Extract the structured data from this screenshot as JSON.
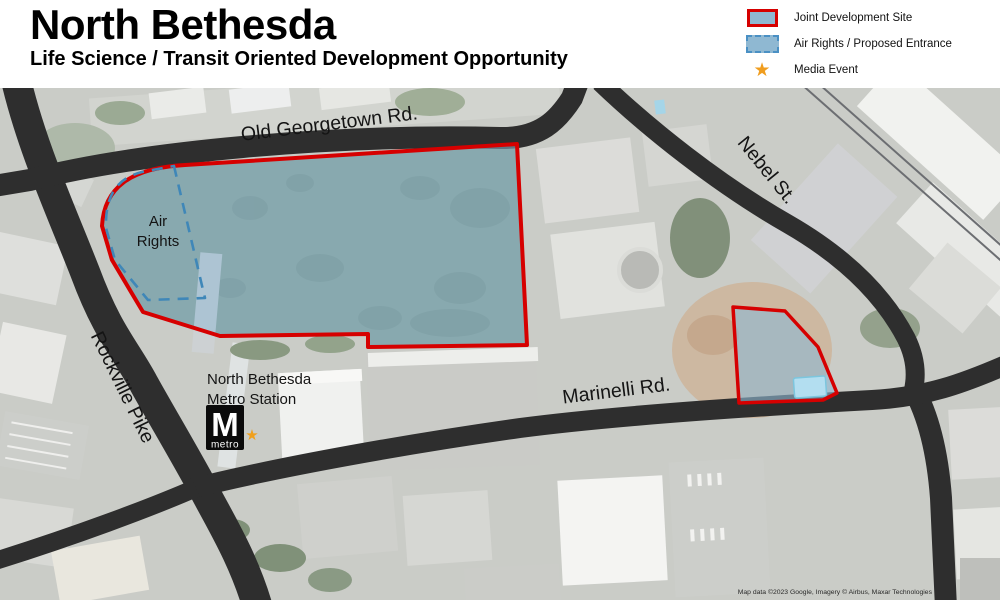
{
  "header": {
    "title": "North Bethesda",
    "subtitle": "Life Science / Transit Oriented Development Opportunity"
  },
  "legend": {
    "items": [
      {
        "swatch": "red-outline-blue-fill",
        "label": "Joint Development Site"
      },
      {
        "swatch": "blue-dashed-blue-fill",
        "label": "Air Rights / Proposed Entrance"
      },
      {
        "swatch": "orange-star",
        "label": "Media Event"
      }
    ]
  },
  "map": {
    "road_labels": {
      "old_georgetown": "Old Georgetown Rd.",
      "nebel": "Nebel St.",
      "rockville": "Rockville Pike",
      "marinelli": "Marinelli Rd."
    },
    "air_rights": {
      "line1": "Air",
      "line2": "Rights"
    },
    "station": {
      "name_line1": "North Bethesda",
      "name_line2": "Metro Station",
      "logo_letter": "M",
      "logo_word": "metro"
    },
    "attribution": "Map data ©2023 Google, Imagery © Airbus, Maxar Technologies"
  },
  "glyphs": {
    "star": "★"
  },
  "colors": {
    "site_outline": "#d60000",
    "site_fill": "#8fb8d2",
    "air_rights_outline": "#3f87b8",
    "media_event_star": "#f09d1e",
    "road": "#2e2e2e"
  }
}
